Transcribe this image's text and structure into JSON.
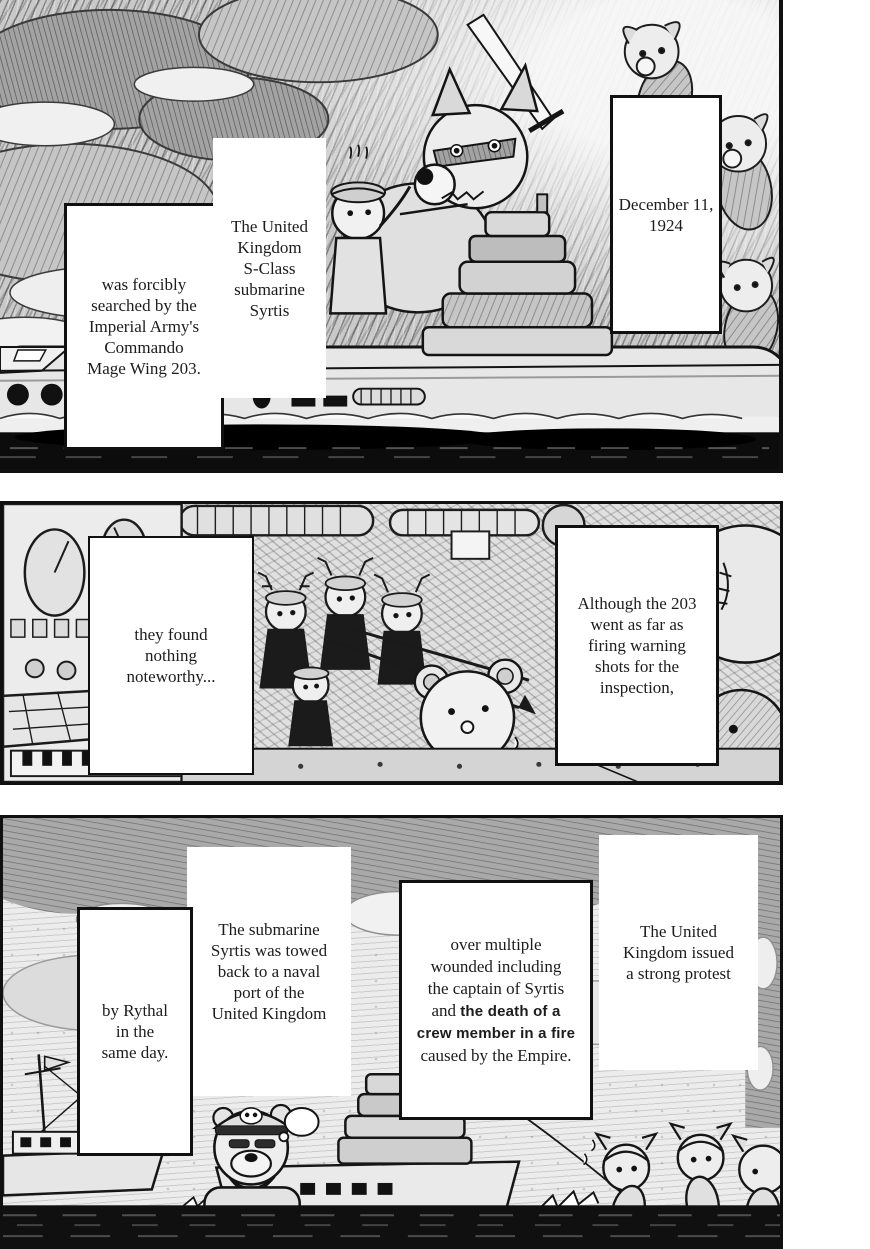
{
  "panel1": {
    "caption_searched": "was forcibly\nsearched by the\nImperial Army's\nCommando\nMage Wing 203.",
    "caption_submarine": "The United\nKingdom\nS-Class\nsubmarine\nSyrtis",
    "caption_date": "December 11,\n1924"
  },
  "panel2": {
    "caption_found": "they found\nnothing\nnoteworthy...",
    "caption_although": "Although the 203\nwent as far as\nfiring warning\nshots for the\ninspection,"
  },
  "panel3": {
    "caption_towed": "The submarine\nSyrtis was towed\nback to a naval\nport of the\nUnited Kingdom",
    "caption_rythal": "by Rythal\nin the\nsame day.",
    "caption_wounded": {
      "l1": "over multiple",
      "l2": "wounded including",
      "l3": "the captain of Syrtis",
      "l4a": "and ",
      "l4b": "the death of a",
      "l5": "crew member in a fire",
      "l6": "caused by the Empire."
    },
    "caption_protest": "The United\nKingdom issued\na strong protest"
  },
  "colors": {
    "ink": "#141414",
    "paper": "#ffffff"
  }
}
